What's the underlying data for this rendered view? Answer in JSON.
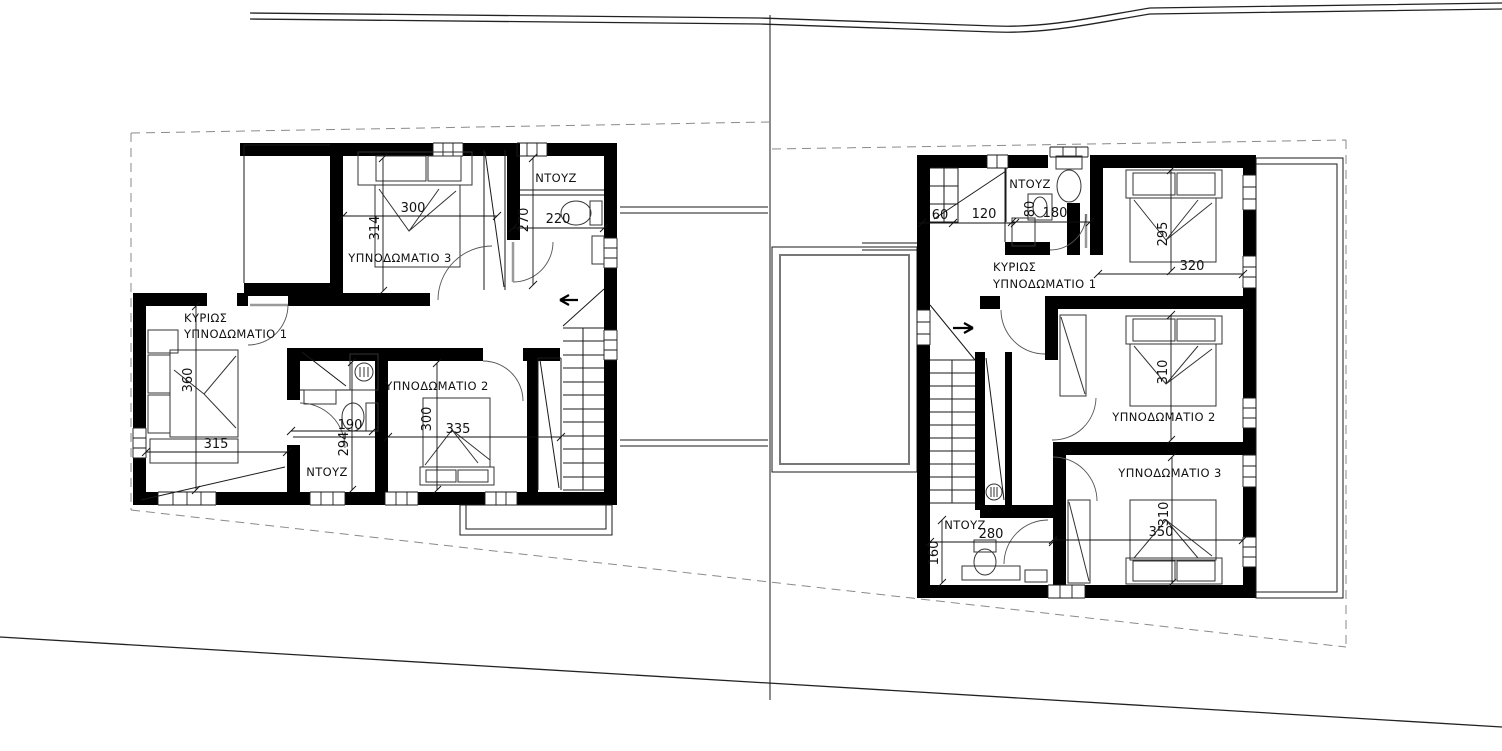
{
  "colors": {
    "wall": "#000000",
    "thin_line": "#1a1a1a",
    "dimension": "#111111",
    "boundary_dash": "#8a8a8a",
    "background": "#ffffff"
  },
  "left": {
    "bed3_label": "ΥΠΝΟΔΩΜΑΤΙΟ 3",
    "bed3_w": "300",
    "bed3_d": "314",
    "shower_label": "ΝΤΟΥΖ",
    "shower_d": "270",
    "shower_w": "220",
    "master_l1": "ΚΥΡΙΩΣ",
    "master_l2": "ΥΠΝΟΔΩΜΑΤΙΟ 1",
    "master_d": "360",
    "master_w": "315",
    "wc_w": "190",
    "wc_d": "294",
    "shower2_label": "ΝΤΟΥΖ",
    "bed2_label": "ΥΠΝΟΔΩΜΑΤΙΟ 2",
    "bed2_d": "300",
    "bed2_w": "335"
  },
  "right": {
    "closet_a": "60",
    "closet_b": "120",
    "shower_label": "ΝΤΟΥΖ",
    "shower_a": "80",
    "shower_b": "180",
    "master_l1": "ΚΥΡΙΩΣ",
    "master_l2": "ΥΠΝΟΔΩΜΑΤΙΟ 1",
    "master_d": "295",
    "master_w": "320",
    "bed2_label": "ΥΠΝΟΔΩΜΑΤΙΟ 2",
    "bed2_d": "310",
    "bed3_label": "ΥΠΝΟΔΩΜΑΤΙΟ 3",
    "bed3_d": "310",
    "bed3_w": "350",
    "shower2_label": "ΝΤΟΥΖ",
    "shower2_w": "280",
    "shower2_d": "160"
  }
}
